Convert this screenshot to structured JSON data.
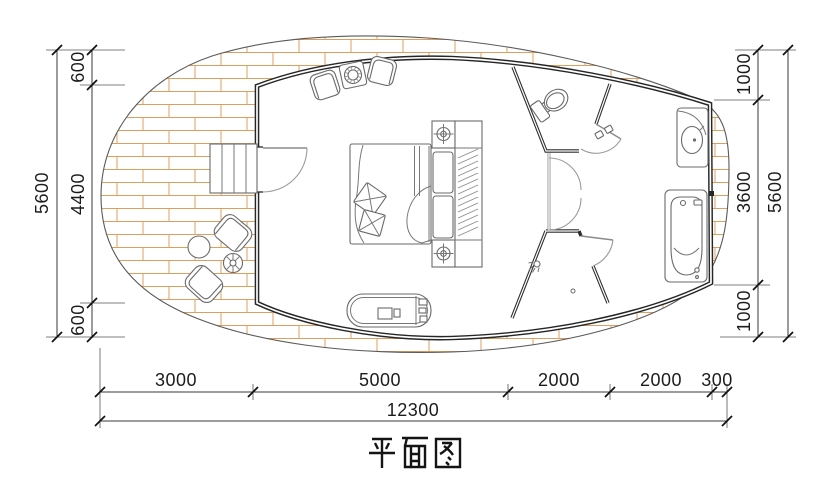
{
  "title": "平面图",
  "colors": {
    "wall": "#262626",
    "deck_hatch": "#dd9f5e",
    "dimension_lines": "#3a3a3a",
    "furniture": "#6a6a6a",
    "background": "#ffffff"
  },
  "dims": {
    "left": [
      "600",
      "4400",
      "600"
    ],
    "left_total": "5600",
    "right": [
      "1000",
      "3600",
      "1000"
    ],
    "right_total": "5600",
    "bottom": [
      "3000",
      "5000",
      "2000",
      "2000",
      "300"
    ],
    "bottom_total": "12300"
  }
}
